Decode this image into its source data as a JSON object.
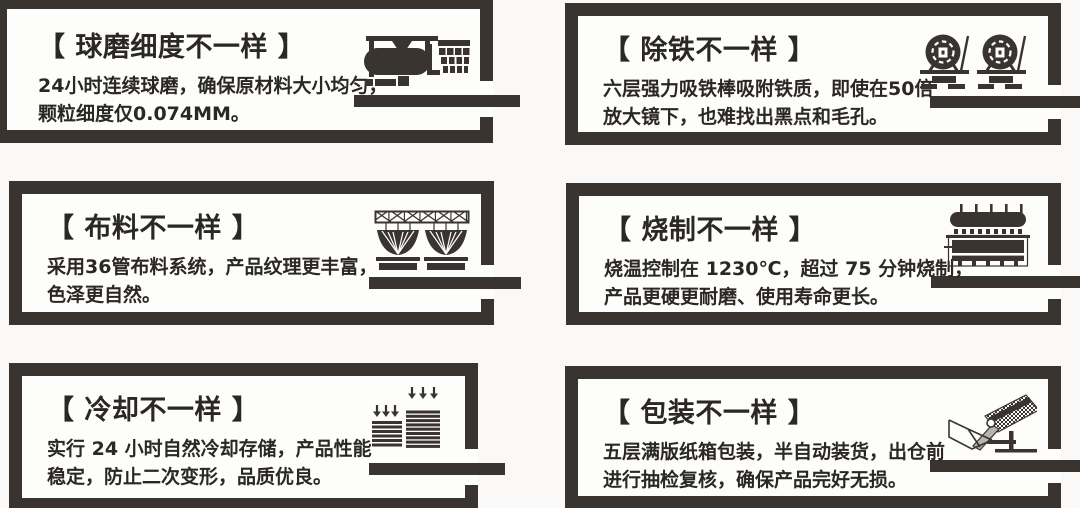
{
  "colors": {
    "ink": "#3a3430",
    "text": "#2b2824",
    "bg": "#faf9f7",
    "panel_bg": "#fdfdfc",
    "chute": "#b7b3af"
  },
  "panels": [
    {
      "key": "ball-milling",
      "title": "【 球磨细度不一样 】",
      "desc_line1": "24小时连续球磨，确保原材料大小均匀，",
      "desc_line2": "颗粒细度仅0.074MM。",
      "icon": "ball-mill-icon"
    },
    {
      "key": "iron-removal",
      "title": "【 除铁不一样 】",
      "desc_line1": "六层强力吸铁棒吸附铁质，即使在50倍",
      "desc_line2": "放大镜下，也难找出黑点和毛孔。",
      "icon": "iron-remover-icon"
    },
    {
      "key": "material-distribution",
      "title": "【 布料不一样 】",
      "desc_line1": "采用36管布料系统，产品纹理更丰富，",
      "desc_line2": "色泽更自然。",
      "icon": "distribution-system-icon"
    },
    {
      "key": "firing",
      "title": "【 烧制不一样 】",
      "desc_line1": "烧温控制在 1230℃，超过 75 分钟烧制，",
      "desc_line2": "产品更硬更耐磨、使用寿命更长。",
      "icon": "kiln-icon"
    },
    {
      "key": "cooling",
      "title": "【 冷却不一样 】",
      "desc_line1": "实行 24 小时自然冷却存储，产品性能",
      "desc_line2": "稳定，防止二次变形，品质优良。",
      "icon": "cooling-stack-icon"
    },
    {
      "key": "packaging",
      "title": "【 包装不一样 】",
      "desc_line1": "五层满版纸箱包装，半自动装货，出仓前",
      "desc_line2": "进行抽检复核，确保产品完好无损。",
      "icon": "packing-machine-icon"
    }
  ]
}
